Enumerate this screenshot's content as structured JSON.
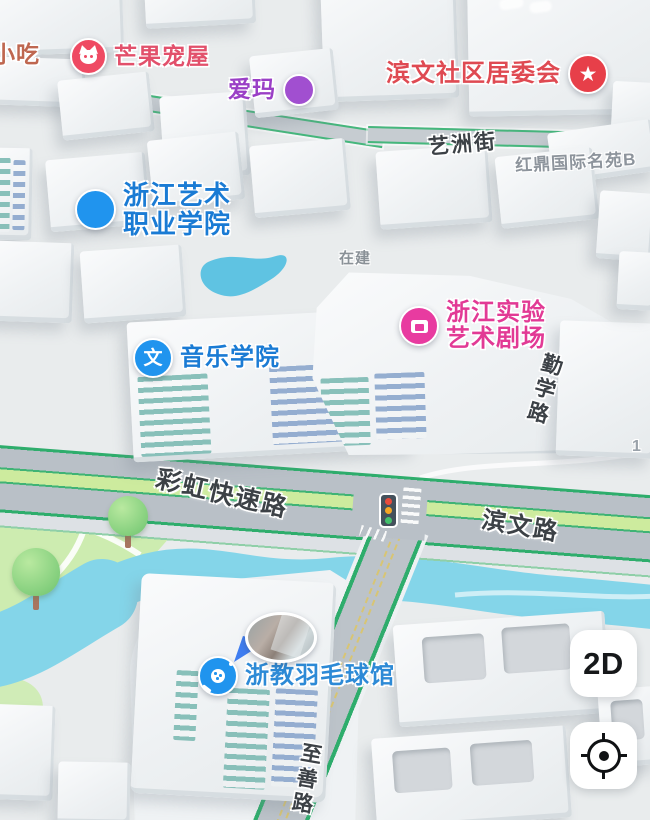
{
  "colors": {
    "bg": "#e9eced",
    "river": "#84d5e9",
    "park": "#cdecb0",
    "road_gray": "#b9c0c7",
    "road_green": "#2ead6c",
    "median_green": "#cdeb9e",
    "red_dash": "#dc4a32",
    "street_text": "#3c4146",
    "area_text": "#8d949c",
    "poi_blue": "#2094ee",
    "poi_blue_text": "#1a7bd4",
    "poi_pink": "#e83ba0",
    "poi_pink_text": "#e23a95",
    "poi_red": "#e73f49",
    "poi_red_text": "#df4a52",
    "poi_purple": "#a14fd0",
    "poi_purple_text": "#9a3fc6",
    "poi_cat": "#ef4a63",
    "poi_cat_text": "#e2506b",
    "xiaochi_text": "#bf6750",
    "signal_red": "#e84b3c",
    "signal_amber": "#f5a623",
    "signal_green": "#43c16c"
  },
  "pois": {
    "xiaochi": {
      "label": "小吃"
    },
    "mango": {
      "label": "芒果宠屋"
    },
    "aima": {
      "label": "爱玛"
    },
    "committee": {
      "label": "滨文社区居委会"
    },
    "college": {
      "line1": "浙江艺术",
      "line2": "职业学院"
    },
    "theater": {
      "line1": "浙江实验",
      "line2": "艺术剧场"
    },
    "music": {
      "label": "音乐学院",
      "glyph": "文"
    },
    "badminton": {
      "label": "浙教羽毛球馆"
    }
  },
  "streets": {
    "yizhou": "艺洲街",
    "caihong": "彩虹快速路",
    "binwen": "滨文路",
    "qinxue": "勤学路",
    "zhishan": "至善路"
  },
  "areas": {
    "hongding": "红鼎国际名苑B",
    "under_construction": "在建",
    "partial_number": "1"
  },
  "controls": {
    "view_mode": "2D"
  }
}
